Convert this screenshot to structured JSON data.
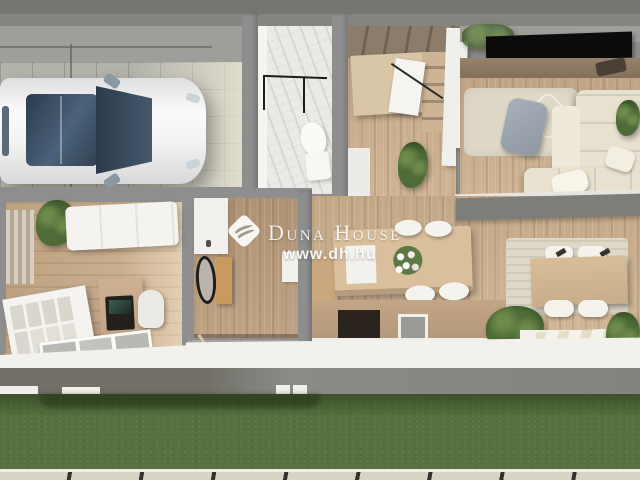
{
  "watermark": {
    "brand": "Duna House",
    "url": "www.dh.hu",
    "logo_icon": "duna-house-diamond-wave-icon"
  },
  "colors": {
    "wall": "#8e8e8e",
    "wall_dark": "#757571",
    "wall_light": "#9e9e9a",
    "white": "#f2f1ec",
    "floor_wood": "#cbb090",
    "floor_wood_dark": "#b89c7e",
    "tile": "#b3b3ab",
    "marble": "#ebeae6",
    "grass": "#57723f",
    "grass_shadow": "#2f4424",
    "pavement": "#d6d3c7",
    "sofa": "#e8e1d0",
    "rug": "#ded8c8",
    "island_wood": "#dabf9d",
    "stair_wood": "#d9c6a6",
    "counter_dark": "#2a231e",
    "tv_black": "#0c0c0c",
    "car_body": "#f4f4f4",
    "car_glass": "#36485a",
    "plant": "#4e6b38",
    "plant_light": "#6d8a4b",
    "plant_dark": "#33491f",
    "console_wood": "#c99a5e",
    "watermark_white": "#ffffff"
  }
}
